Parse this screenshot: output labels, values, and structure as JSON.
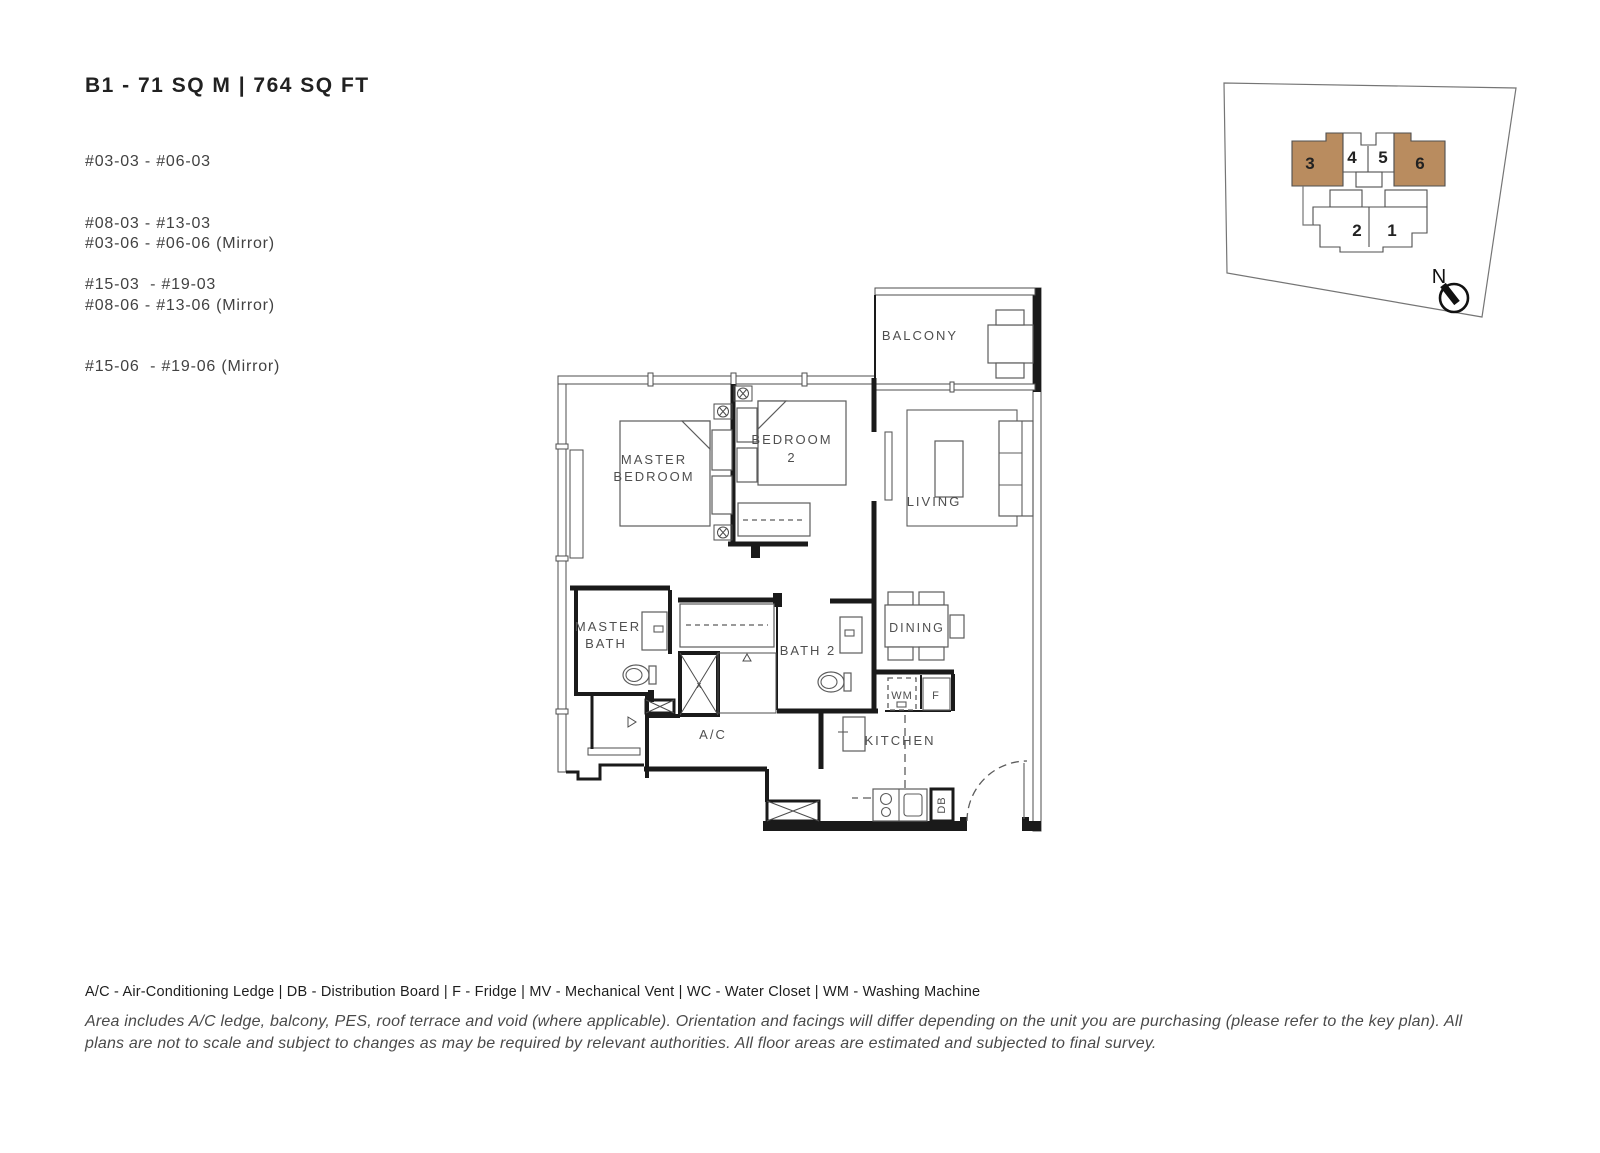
{
  "header": {
    "title": "B1 - 71 SQ M | 764 SQ FT",
    "unit_groups": [
      {
        "lines": [
          "#03-03 - #06-03",
          "#08-03 - #13-03",
          "#15-03  - #19-03"
        ]
      },
      {
        "lines": [
          "#03-06 - #06-06 (Mirror)",
          "#08-06 - #13-06 (Mirror)",
          "#15-06  - #19-06 (Mirror)"
        ]
      }
    ]
  },
  "key_plan": {
    "highlight_color": "#b98c5f",
    "north_label": "N",
    "units": [
      {
        "label": "3",
        "highlighted": true
      },
      {
        "label": "4",
        "highlighted": false
      },
      {
        "label": "5",
        "highlighted": false
      },
      {
        "label": "6",
        "highlighted": true
      },
      {
        "label": "2",
        "highlighted": false
      },
      {
        "label": "1",
        "highlighted": false
      }
    ]
  },
  "floor_plan": {
    "labels": {
      "balcony": "BALCONY",
      "master_bedroom_line1": "MASTER",
      "master_bedroom_line2": "BEDROOM",
      "bedroom2_line1": "BEDROOM",
      "bedroom2_line2": "2",
      "living": "LIVING",
      "master_bath_line1": "MASTER",
      "master_bath_line2": "BATH",
      "bath2": "BATH 2",
      "dining": "DINING",
      "wm": "WM",
      "fridge": "F",
      "ac": "A/C",
      "kitchen": "KITCHEN",
      "db": "DB",
      "shower_mark": "x"
    }
  },
  "legend": "A/C - Air-Conditioning Ledge | DB - Distribution Board | F - Fridge | MV - Mechanical Vent | WC - Water Closet | WM - Washing Machine",
  "disclaimer": "Area includes A/C ledge, balcony, PES, roof terrace and void (where applicable). Orientation and facings will differ depending on the unit you are purchasing (please refer to the key plan). All plans are not to scale and subject to changes as may be required by relevant authorities. All floor areas are estimated and subjected to final survey."
}
